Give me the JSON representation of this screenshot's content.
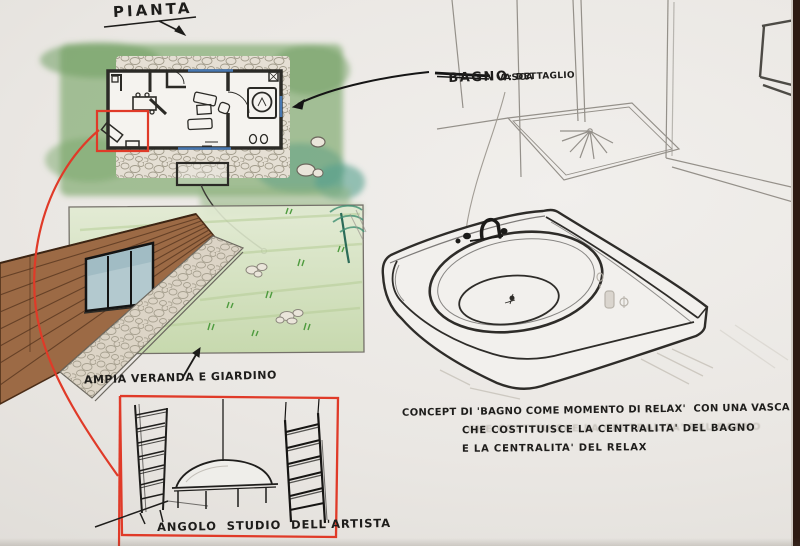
{
  "labels": {
    "plan_title": "PIANTA",
    "bath_title": "BAGNO",
    "bath_subtitle": ": DETTAGLIO",
    "bath_subtitle_line2": "VASCA",
    "veranda_caption": "AMPIA VERANDA E GIARDINO",
    "studio_caption": "ANGOLO STUDIO DELL'ARTISTA"
  },
  "concept_note": {
    "line1": "CONCEPT DI 'BAGNO COME MOMENTO DI RELAX'  CON UNA VASCA",
    "line2": "CHE COSTITUISCE LA CENTRALITA' DEL BAGNO",
    "line3": "E LA CENTRALITA' DEL RELAX"
  },
  "colors": {
    "paper": "#eceae6",
    "ink": "#1f1e1c",
    "pencil_gray": "#908c85",
    "marker_red": "#e03a28",
    "wash_green": "#8fb380",
    "wash_teal": "#57a08d",
    "wood_brown": "#9c6a45",
    "glass_blue": "#b3c9cf",
    "window_blue": "#4a7fc1",
    "photo_edge_brown": "#2d1a12"
  }
}
